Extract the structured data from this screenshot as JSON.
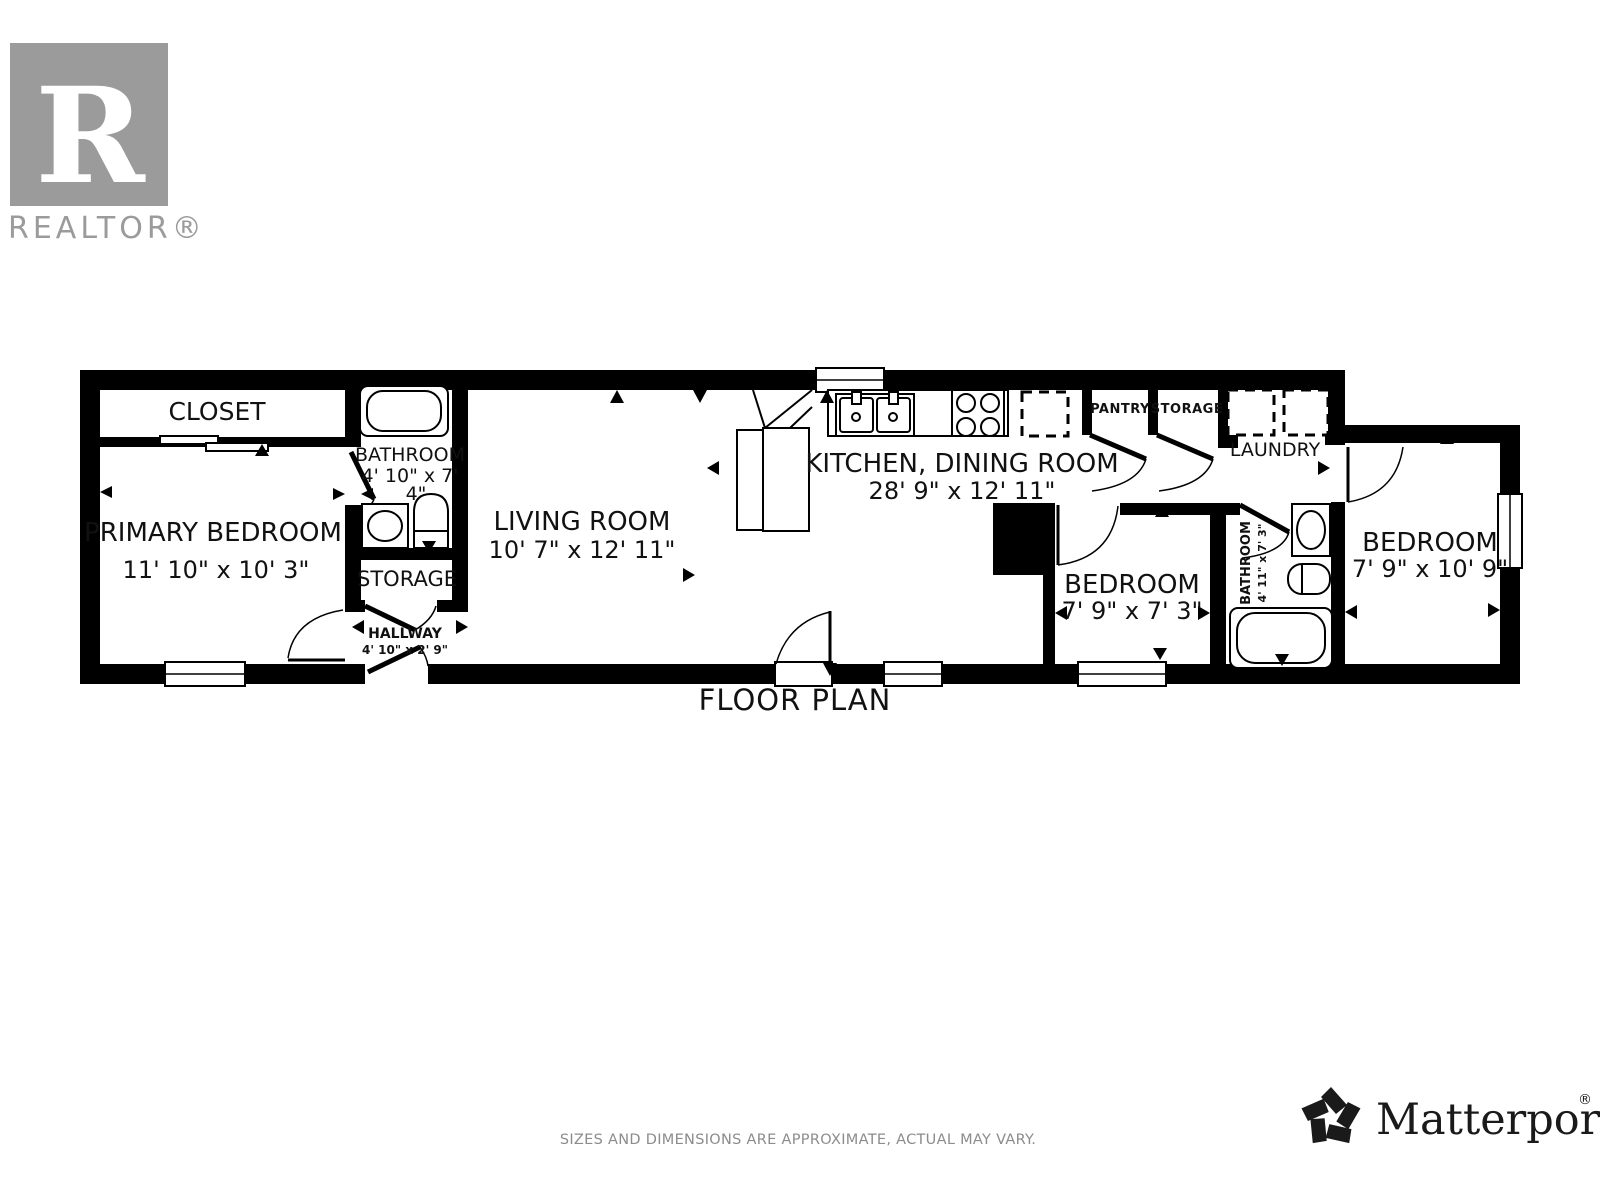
{
  "branding": {
    "realtor": {
      "letter": "R",
      "wordmark": "REALTOR®"
    },
    "matterport": {
      "wordmark": "Matterport",
      "registered": "®"
    }
  },
  "plan": {
    "title": "FLOOR PLAN",
    "rooms": {
      "closet": {
        "name": "CLOSET"
      },
      "bathroom_main": {
        "name": "BATHROOM",
        "dims_line1": "4' 10\" x 7'",
        "dims_line2": "4\""
      },
      "primary_bedroom": {
        "name": "PRIMARY BEDROOM",
        "dims": "11' 10\" x 10' 3\""
      },
      "storage_hall": {
        "name": "STORAGE"
      },
      "hallway": {
        "name": "HALLWAY",
        "dims": "4' 10\" x 2' 9\""
      },
      "living_room": {
        "name": "LIVING ROOM",
        "dims": "10' 7\" x 12' 11\""
      },
      "kitchen_dining": {
        "name": "KITCHEN, DINING ROOM",
        "dims": "28' 9\" x 12' 11\""
      },
      "pantry": {
        "name": "PANTRY"
      },
      "storage_kitchen": {
        "name": "STORAGE"
      },
      "laundry": {
        "name": "LAUNDRY"
      },
      "bedroom_middle": {
        "name": "BEDROOM",
        "dims": "7' 9\" x 7' 3\""
      },
      "bathroom_second": {
        "name": "BATHROOM",
        "dims": "4' 11\" x 7' 3\""
      },
      "bedroom_right": {
        "name": "BEDROOM",
        "dims": "7' 9\" x 10' 9\""
      }
    },
    "fixtures": [
      "bathtub",
      "toilet",
      "pedestal-sink",
      "double-kitchen-sink",
      "stove-4-burner",
      "refrigerator-dashed",
      "washer-dashed",
      "dryer-dashed",
      "sliding-closet-door",
      "hinged-door",
      "window"
    ]
  },
  "footer": {
    "disclaimer": "SIZES AND DIMENSIONS ARE APPROXIMATE, ACTUAL MAY VARY."
  },
  "colors": {
    "wall": "#000000",
    "label_text": "#111111",
    "realtor_gray": "#9b9b9b",
    "disclaimer_gray": "#8c8c8c"
  }
}
